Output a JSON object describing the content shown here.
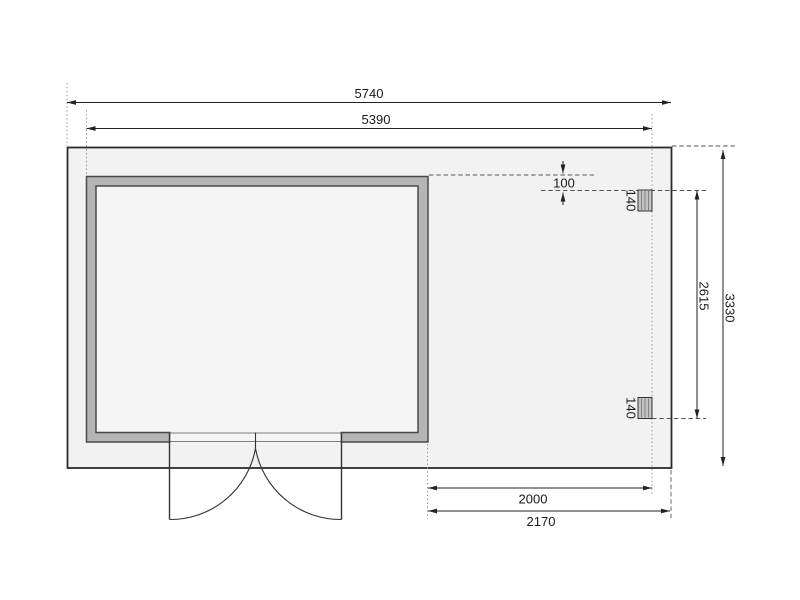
{
  "drawing": {
    "kind": "shed-floor-plan",
    "dimensions": {
      "total_width": "5740",
      "roof_width": "5390",
      "roof_offset": "100",
      "post_size_top": "140",
      "post_span": "2615",
      "total_depth": "3330",
      "post_size_bottom": "140",
      "annex_inner_width": "2000",
      "annex_total_width": "2170"
    },
    "colors": {
      "background": "#ffffff",
      "slab_fill": "#f2f2f2",
      "wall_fill": "#b5b5b5",
      "room_fill": "#f5f5f5",
      "post_fill": "#c4c4c4",
      "line": "#2b2b2b",
      "dim_line": "#222222",
      "extension": "#999999"
    }
  }
}
